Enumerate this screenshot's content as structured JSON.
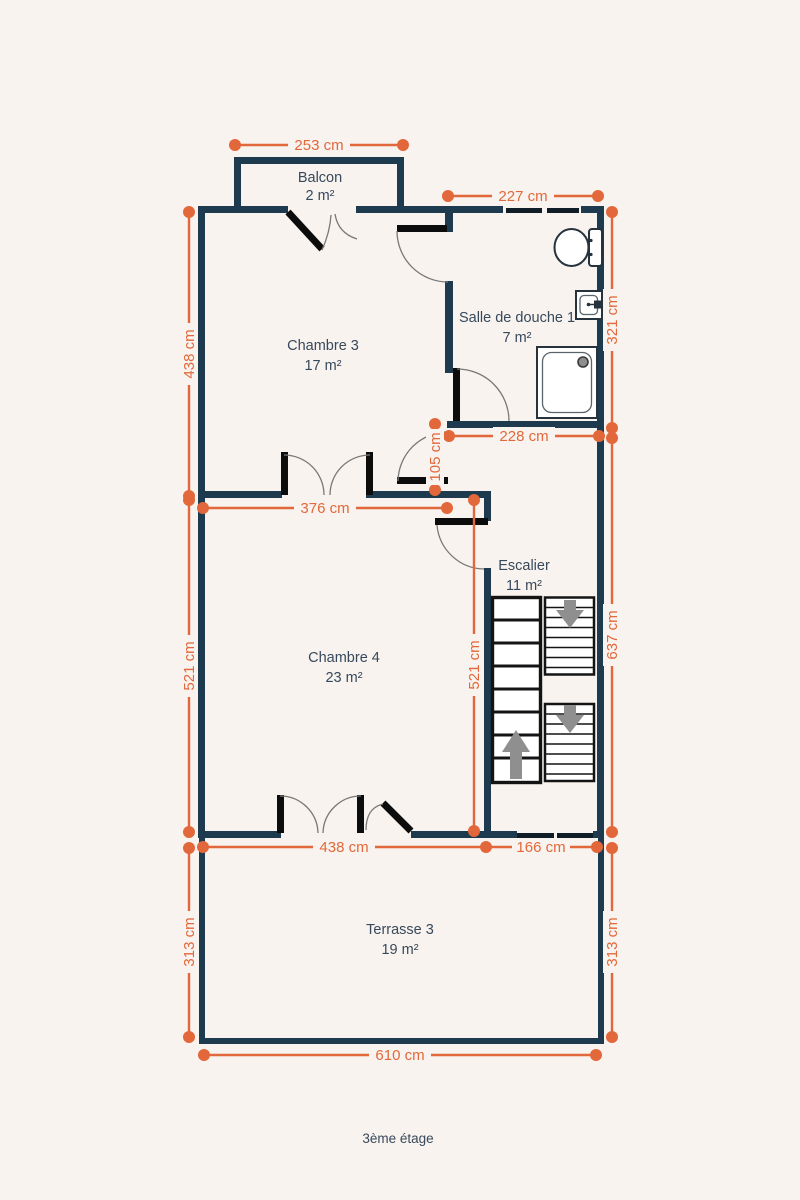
{
  "floor": {
    "label": "3ème étage"
  },
  "colors": {
    "background": "#f8f3ee",
    "wall": "#1d3a4e",
    "dimension": "#e2683b",
    "room_label": "#37495c",
    "stair_arrow": "#8f8f8f",
    "window_bar": "#101c26",
    "door_leaf": "#0c0c0c"
  },
  "rooms": [
    {
      "name": "Balcon",
      "area": "2 m²"
    },
    {
      "name": "Chambre 3",
      "area": "17 m²"
    },
    {
      "name": "Salle de douche 1",
      "area": "7 m²"
    },
    {
      "name": "Escalier",
      "area": "11 m²"
    },
    {
      "name": "Chambre 4",
      "area": "23 m²"
    },
    {
      "name": "Terrasse 3",
      "area": "19 m²"
    }
  ],
  "dims": [
    {
      "label": "253 cm",
      "orientation": "horizontal"
    },
    {
      "label": "227 cm",
      "orientation": "horizontal"
    },
    {
      "label": "438 cm",
      "orientation": "vertical"
    },
    {
      "label": "321 cm",
      "orientation": "vertical"
    },
    {
      "label": "228 cm",
      "orientation": "horizontal"
    },
    {
      "label": "105 cm",
      "orientation": "vertical"
    },
    {
      "label": "376 cm",
      "orientation": "horizontal"
    },
    {
      "label": "521 cm",
      "orientation": "vertical"
    },
    {
      "label": "521 cm",
      "orientation": "vertical"
    },
    {
      "label": "637 cm",
      "orientation": "vertical"
    },
    {
      "label": "438 cm",
      "orientation": "horizontal"
    },
    {
      "label": "166 cm",
      "orientation": "horizontal"
    },
    {
      "label": "313 cm",
      "orientation": "vertical"
    },
    {
      "label": "313 cm",
      "orientation": "vertical"
    },
    {
      "label": "610 cm",
      "orientation": "horizontal"
    }
  ],
  "icons": {
    "toilet": "toilet-icon",
    "sink": "sink-icon",
    "shower": "shower-tray-icon",
    "stair_up": "arrow-up-icon",
    "stair_down": "arrow-down-icon"
  }
}
